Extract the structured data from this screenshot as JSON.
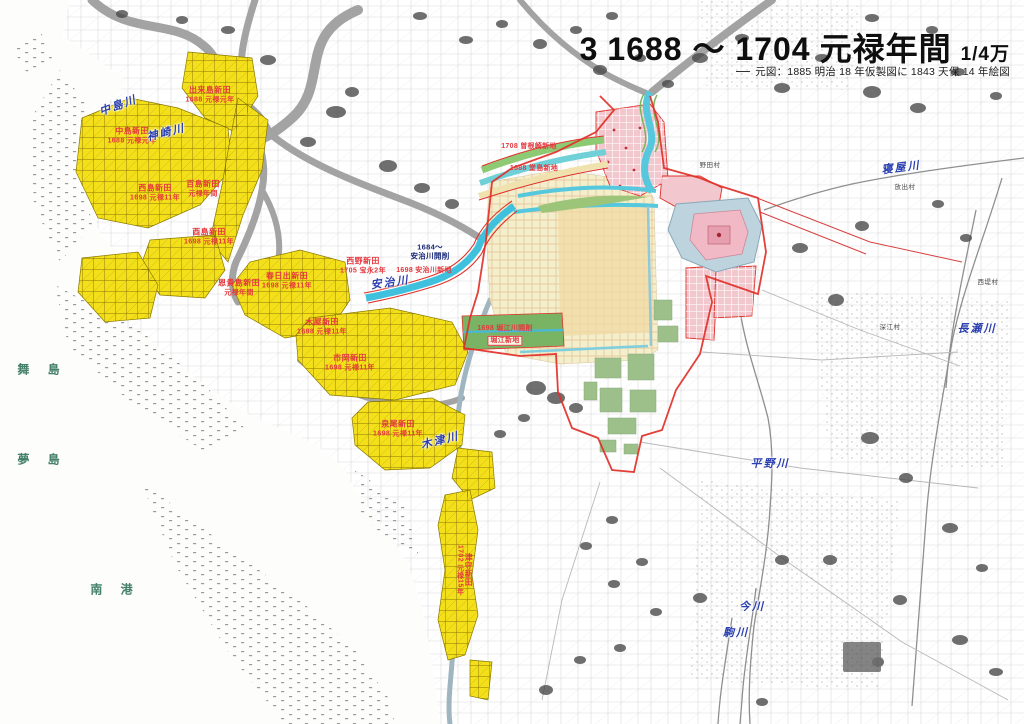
{
  "title": {
    "sheet_no": "3",
    "range": "1688 ～ 1704",
    "era": "元禄年間",
    "scale": "1/4万",
    "source_note": "元図：1885 明治 18 年仮製図に 1843 天保 14 年絵図"
  },
  "shinden": [
    {
      "name": "出来島新田",
      "date": "1688 元禄元年"
    },
    {
      "name": "中島新田",
      "date": "1688 元禄元年"
    },
    {
      "name": "西島新田",
      "date": "1698 元禄11年"
    },
    {
      "name": "百島新田",
      "date": "元禄年間"
    },
    {
      "name": "酉島新田",
      "date": "1698 元禄11年"
    },
    {
      "name": "恩貴島新田",
      "date": "元禄年間"
    },
    {
      "name": "春日出新田",
      "date": "1698 元禄11年"
    },
    {
      "name": "木屋新田",
      "date": "1698 元禄11年"
    },
    {
      "name": "市岡新田",
      "date": "1698 元禄11年"
    },
    {
      "name": "泉尾新田",
      "date": "1698 元禄11年"
    },
    {
      "name": "津守新田",
      "date": "1702 元禄15年"
    },
    {
      "name": "西野新田",
      "date": "1705 宝永2年"
    }
  ],
  "annotations": {
    "sonezaki": "1708 曽根崎新地",
    "dojima": "1688 堂島新地",
    "ajigawa_dig": "1684～\n安治川開削",
    "ajigawa_shinchi": "1698 安治川新地",
    "horie_dig": "1698 堀江川開削",
    "horie_shinchi": "堀江新地"
  },
  "rivers": [
    "中島川",
    "神崎川",
    "安治川",
    "木津川",
    "寝屋川",
    "長瀬川",
    "平野川",
    "今川",
    "駒川"
  ],
  "sea_labels": [
    "舞 島",
    "夢 島",
    "南 港"
  ],
  "villages": [
    "野田村",
    "放出村",
    "西堤村",
    "深江村"
  ],
  "colors": {
    "shinden_fill": "#f4e01a",
    "shinden_label": "#e5383f",
    "river_label": "#2b3faf",
    "sea_label": "#44806a",
    "city_pink": "#f2c7ce",
    "city_cream": "#f3eecb",
    "temple_green": "#9dc08b",
    "water_cyan": "#3fc0dc",
    "boundary_red": "#e03028",
    "note_navy": "#1b2a7a"
  }
}
